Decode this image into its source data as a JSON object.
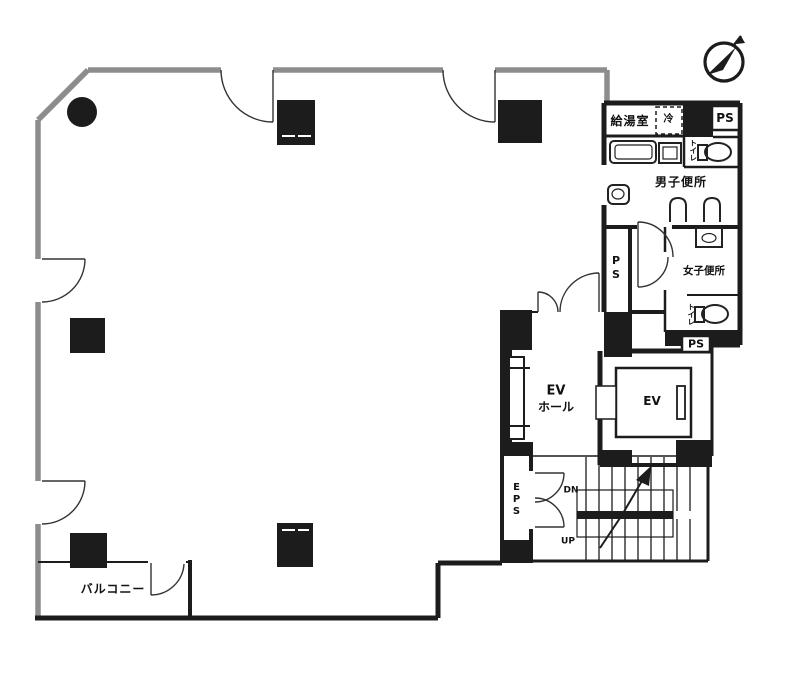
{
  "title": "floor-plan",
  "colors": {
    "wall_black": "#1c1c1c",
    "wall_gray": "#8d8d8d",
    "background": "#ffffff"
  },
  "icons": {
    "compass": "north-arrow-compass"
  },
  "labels": {
    "kitchenette": "給湯室",
    "fridge": "冷",
    "ps": "PS",
    "mens_toilet": "男子便所",
    "womens_toilet": "女子便所",
    "toilet": "トイレ",
    "ev_hall_line1": "EV",
    "ev_hall_line2": "ホール",
    "ev": "EV",
    "eps": "EPS",
    "down": "DN",
    "up": "UP",
    "balcony": "バルコニー"
  }
}
